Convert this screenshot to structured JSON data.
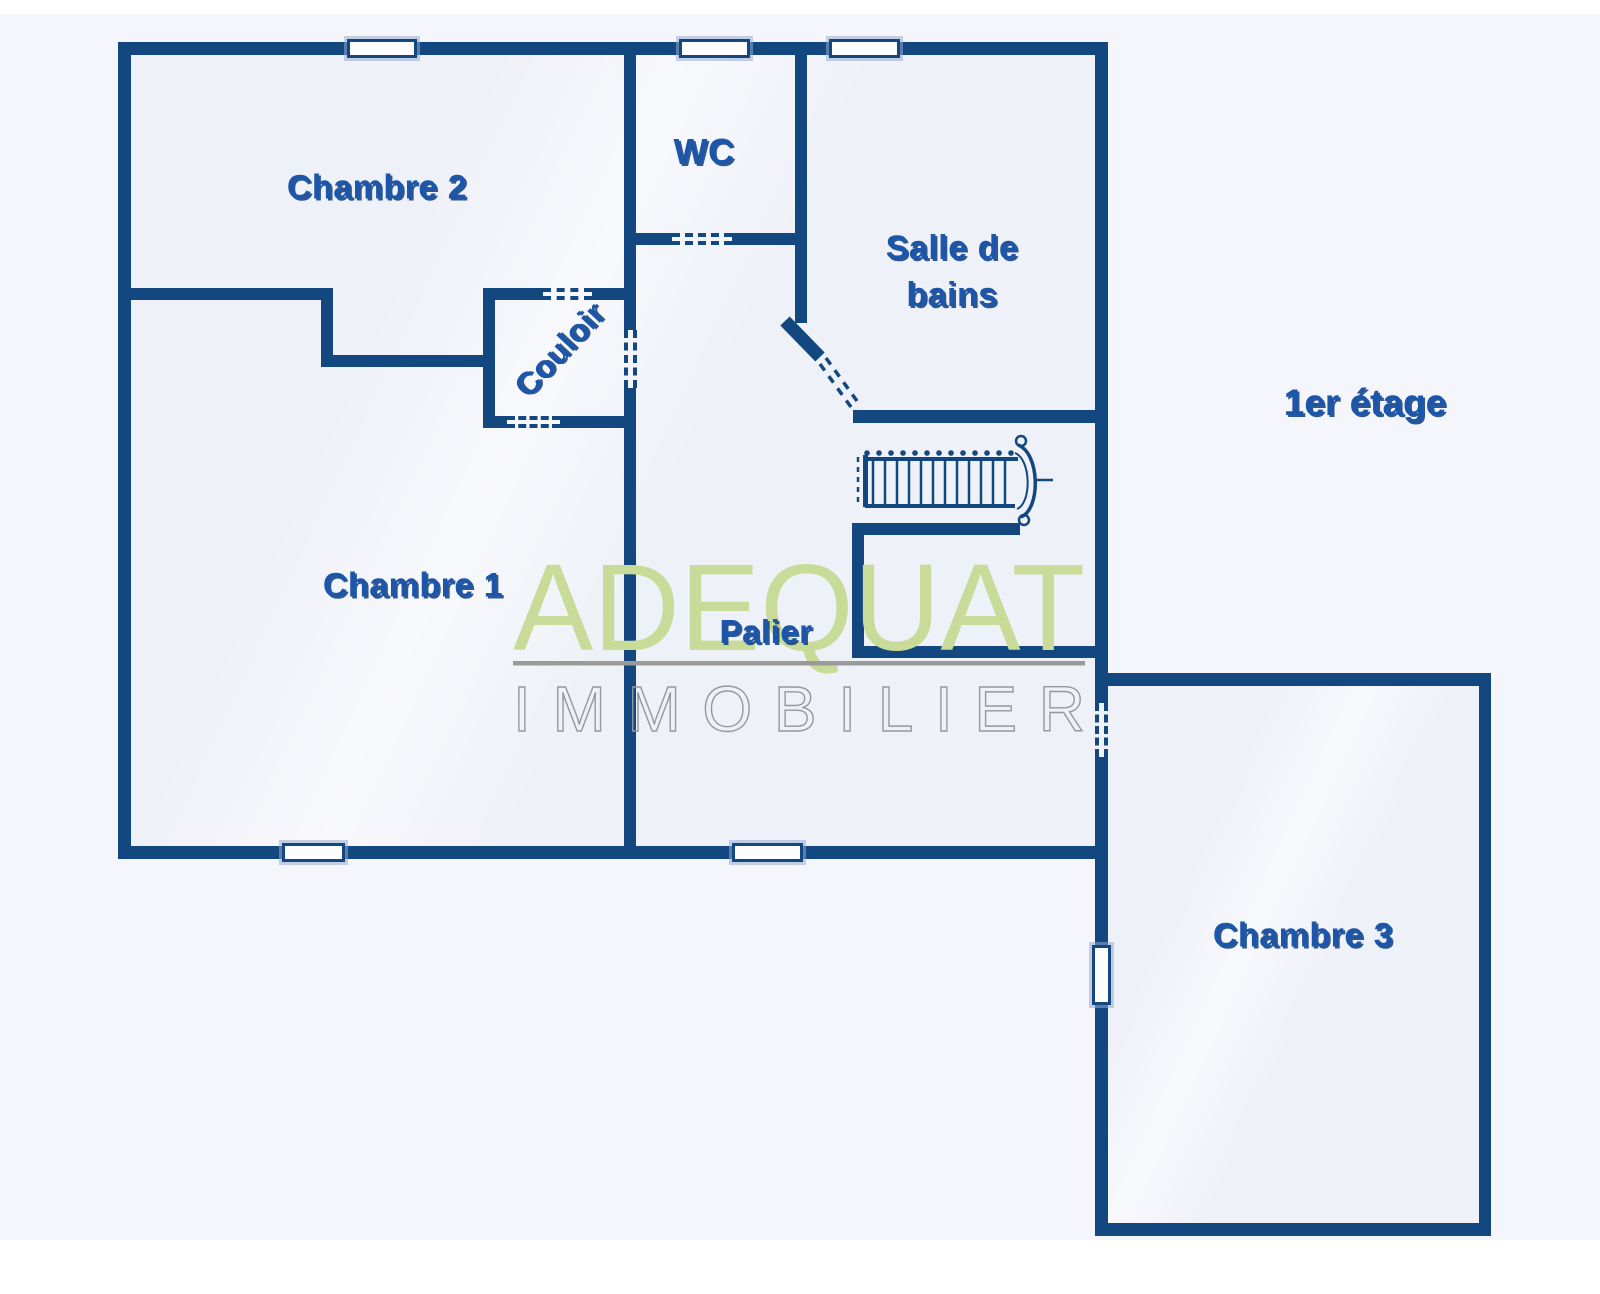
{
  "floor": {
    "label": "1er étage"
  },
  "rooms": {
    "chambre2": {
      "label": "Chambre 2"
    },
    "wc": {
      "label": "WC"
    },
    "salle_de_bains": {
      "line1": "Salle de",
      "line2": "bains"
    },
    "couloir": {
      "label": "Couloir"
    },
    "chambre1": {
      "label": "Chambre 1"
    },
    "palier": {
      "label": "Palier"
    },
    "chambre3": {
      "label": "Chambre 3"
    }
  },
  "watermark": {
    "brand": "ADEQUAT",
    "subtitle": "IMMOBILIER",
    "brand_color": "#c8db99",
    "subtitle_color": "#97979d",
    "divider_color": "#9a9a9a"
  },
  "colors": {
    "wall": "#12477f",
    "room_label": "#1b56ab",
    "room_fill": "#eff1f8",
    "canvas": "#f5f6fb"
  }
}
